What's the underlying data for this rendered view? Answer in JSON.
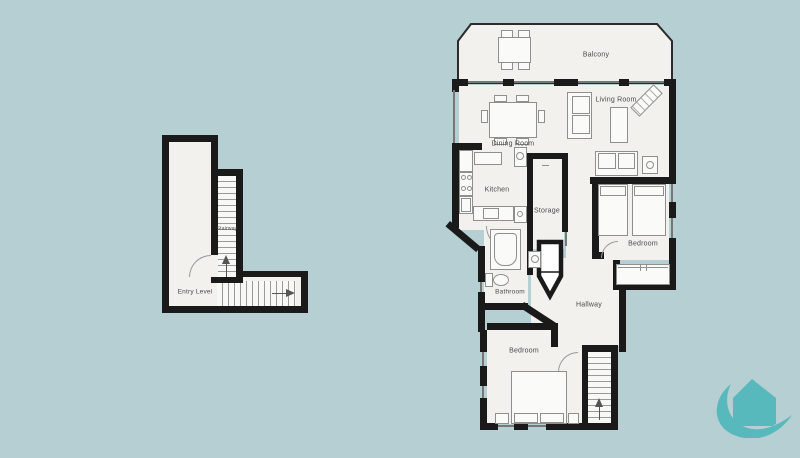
{
  "colors": {
    "background": "#b5cfd2",
    "floor_fill": "#f2f1ed",
    "wall": "#1a1a1a",
    "furniture_outline": "#8f8f8f",
    "label_text": "#4a4a4a",
    "logo_teal": "#58b9bd"
  },
  "entry_plan": {
    "labels": {
      "entry_level": "Entry Level",
      "stairway": "Stairway"
    }
  },
  "main_plan": {
    "labels": {
      "balcony": "Balcony",
      "living_room": "Living Room",
      "dining_room": "Dining Room",
      "kitchen": "Kitchen",
      "storage": "Storage",
      "bedroom_right": "Bedroom",
      "bathroom": "Bathroom",
      "hallway": "Hallway",
      "bedroom_lower": "Bedroom"
    }
  },
  "icons": {
    "stairs_direction_up": "up-arrow-icon",
    "stairs_direction_right": "right-arrow-icon",
    "brand_logo": "house-wave-logo-icon"
  }
}
